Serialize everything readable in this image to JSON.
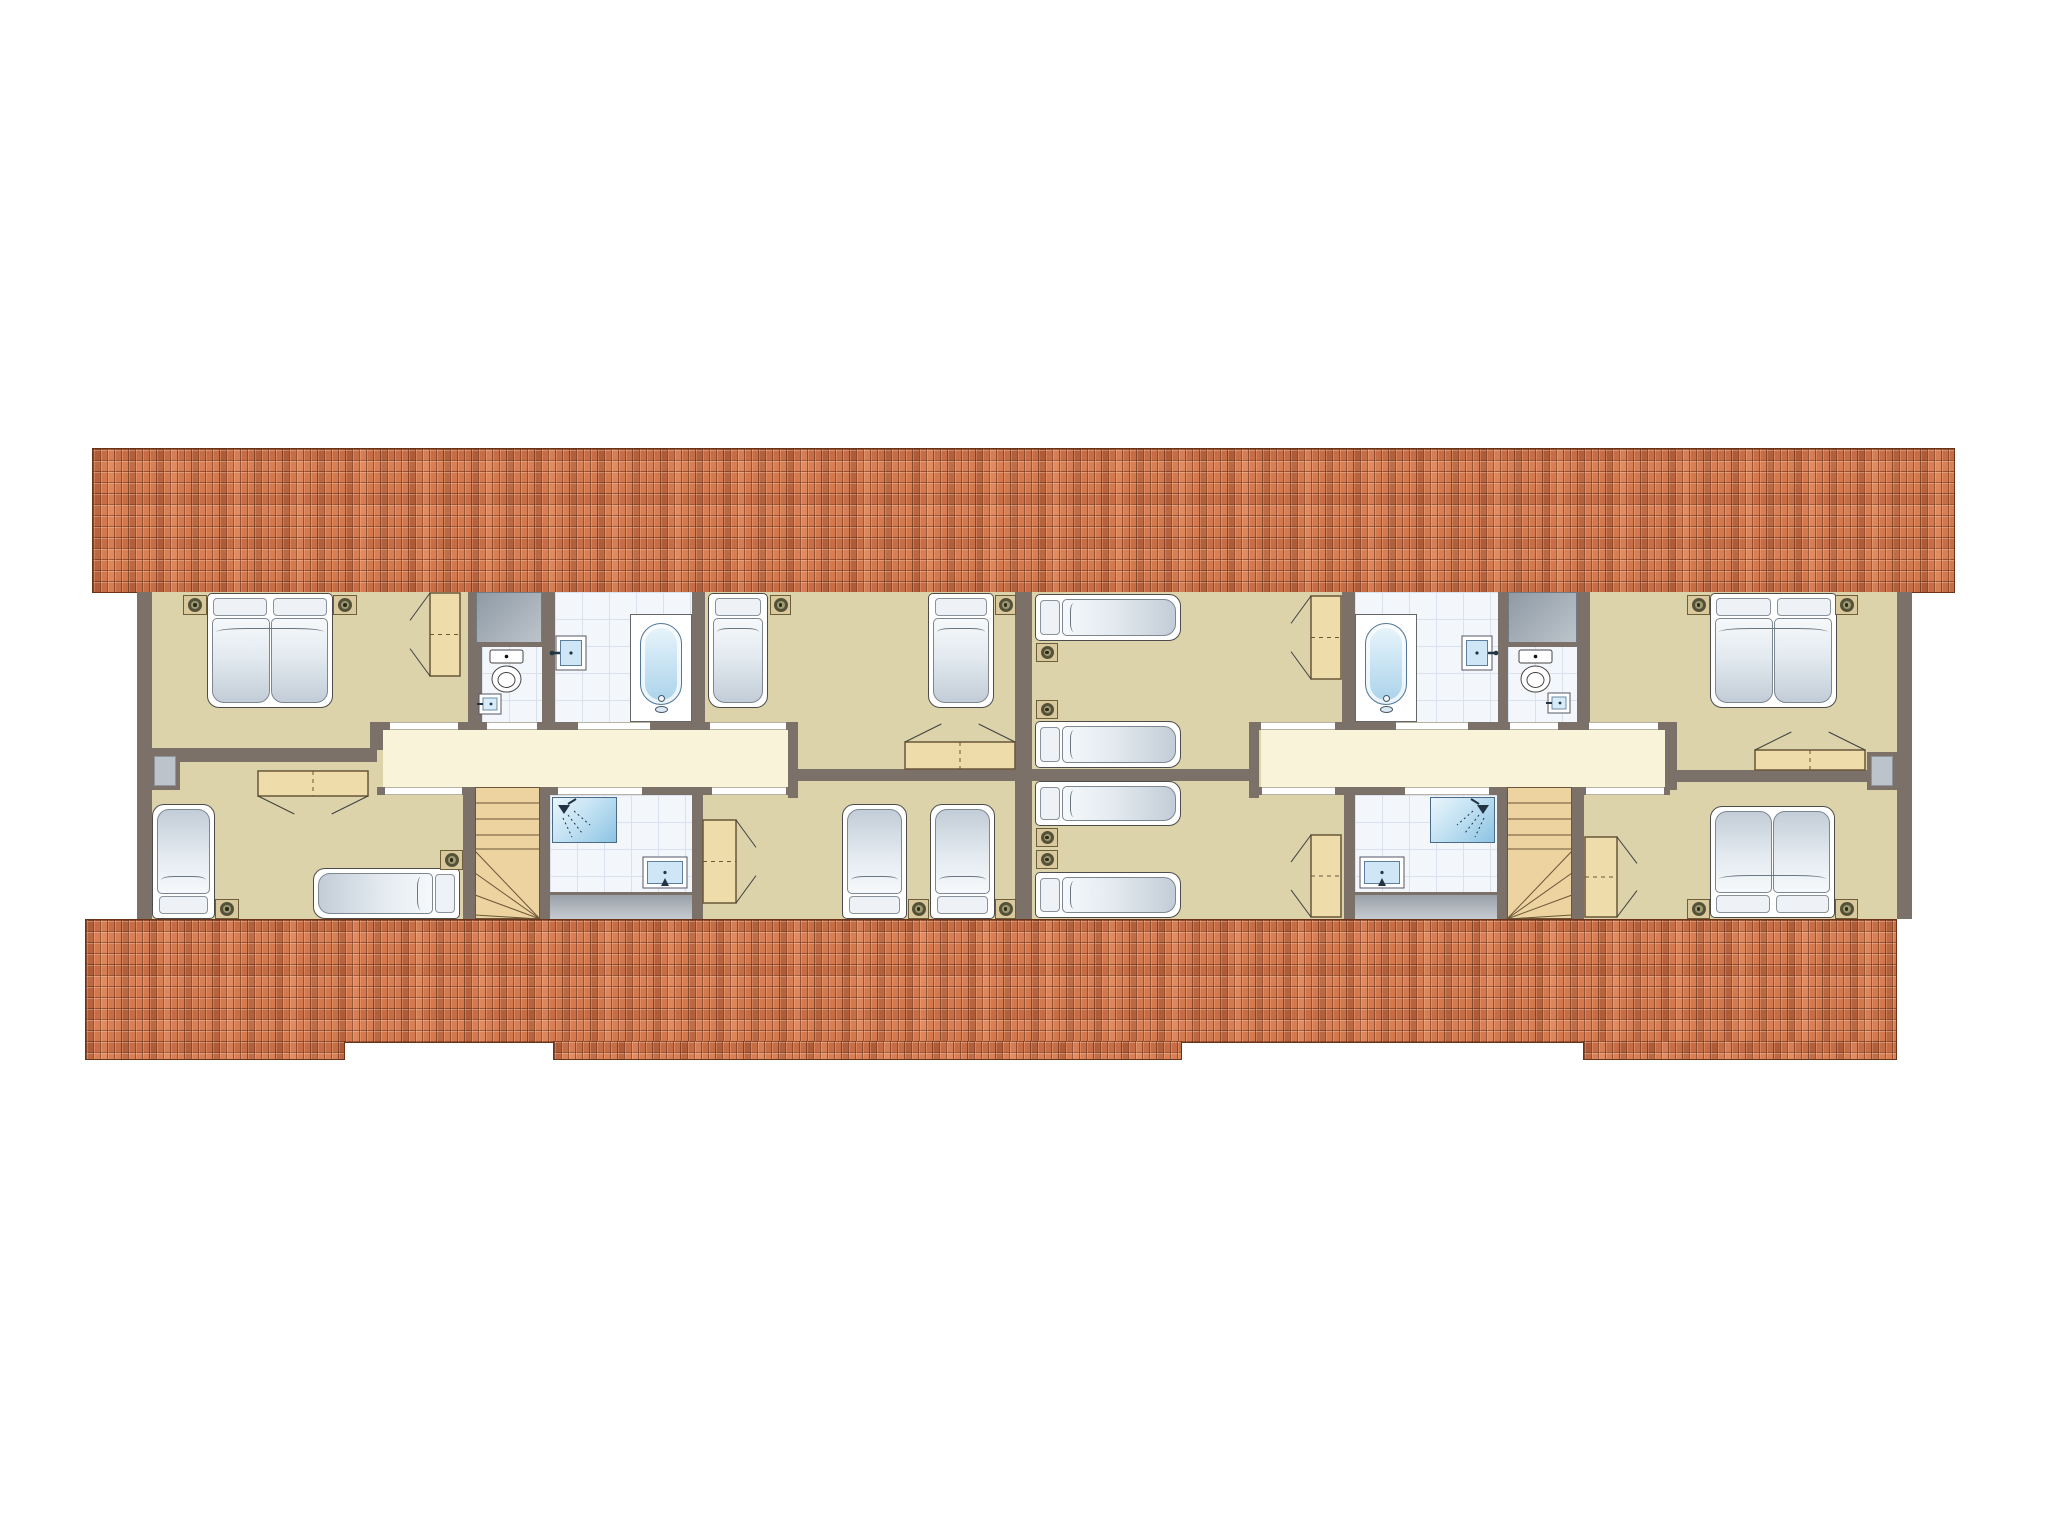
{
  "palette": {
    "background": "#ffffff",
    "wall": "#7b7168",
    "room": "#dcd3ab",
    "hall": "#f9f3da",
    "tilebg": "#f3f6fa",
    "tileline": "#d9e2ec",
    "roof": "#d4784e",
    "roofline": "#6b3418",
    "wood": "#eedcab",
    "wooddark": "#6a5638",
    "stairs": "#ecd3a0",
    "nightstand": "#d9c99c",
    "window": "#bcc3ca"
  },
  "scene": {
    "canvas": {
      "w": 2048,
      "h": 1536
    },
    "items": [
      {
        "n": "roof-band-top",
        "t": "roof",
        "x": 92,
        "y": 448,
        "w": 1863,
        "h": 145
      },
      {
        "n": "floor-base",
        "t": "beige",
        "x": 137,
        "y": 592,
        "w": 1775,
        "h": 327
      },
      {
        "n": "corridor-left",
        "t": "cream",
        "x": 383,
        "y": 730,
        "w": 405,
        "h": 57
      },
      {
        "n": "corridor-right",
        "t": "cream",
        "x": 1261,
        "y": 730,
        "w": 404,
        "h": 57
      },
      {
        "n": "wc-left-floor",
        "t": "tile",
        "x": 482,
        "y": 592,
        "w": 60,
        "h": 130
      },
      {
        "n": "bath-left-floor",
        "t": "tile",
        "x": 555,
        "y": 592,
        "w": 137,
        "h": 130
      },
      {
        "n": "shower-left-floor",
        "t": "tile",
        "x": 550,
        "y": 795,
        "w": 142,
        "h": 97
      },
      {
        "n": "bath-right-floor",
        "t": "tile",
        "x": 1355,
        "y": 592,
        "w": 143,
        "h": 130
      },
      {
        "n": "wc-right-floor",
        "t": "tile",
        "x": 1508,
        "y": 592,
        "w": 69,
        "h": 130
      },
      {
        "n": "shower-right-floor",
        "t": "tile",
        "x": 1355,
        "y": 795,
        "w": 142,
        "h": 97
      },
      {
        "n": "knee-strip-left",
        "t": "graystrip",
        "x": 550,
        "y": 892,
        "w": 142,
        "h": 27
      },
      {
        "n": "knee-strip-right",
        "t": "graystrip",
        "x": 1355,
        "y": 892,
        "w": 142,
        "h": 27
      },
      {
        "n": "wall-left-outer",
        "t": "wall",
        "x": 137,
        "y": 592,
        "w": 15,
        "h": 327
      },
      {
        "n": "wall-party",
        "t": "wall",
        "x": 1015,
        "y": 592,
        "w": 17,
        "h": 327
      },
      {
        "n": "wall-right-outer",
        "t": "wall",
        "x": 1897,
        "y": 592,
        "w": 15,
        "h": 327
      },
      {
        "n": "wall-rooma-wc",
        "t": "wall",
        "x": 468,
        "y": 592,
        "w": 14,
        "h": 138
      },
      {
        "n": "wall-wc-bath-left",
        "t": "wall",
        "x": 542,
        "y": 592,
        "w": 13,
        "h": 130
      },
      {
        "n": "wall-bath-roomb",
        "t": "wall",
        "x": 692,
        "y": 592,
        "w": 13,
        "h": 130
      },
      {
        "n": "wall-corridor-top-left",
        "t": "wall",
        "x": 377,
        "y": 722,
        "w": 421,
        "h": 8
      },
      {
        "n": "wall-corridor-left-cap",
        "t": "wall",
        "x": 370,
        "y": 722,
        "w": 13,
        "h": 28
      },
      {
        "n": "wall-ac-divider",
        "t": "wall",
        "x": 145,
        "y": 748,
        "w": 232,
        "h": 14
      },
      {
        "n": "wall-corridor-bottom-left",
        "t": "wall",
        "x": 377,
        "y": 787,
        "w": 421,
        "h": 8
      },
      {
        "n": "wall-roomc-stairs",
        "t": "wall",
        "x": 463,
        "y": 795,
        "w": 12,
        "h": 124
      },
      {
        "n": "wall-stairs-shower-left",
        "t": "wall",
        "x": 540,
        "y": 787,
        "w": 10,
        "h": 132
      },
      {
        "n": "wall-shower-roomd",
        "t": "wall",
        "x": 692,
        "y": 795,
        "w": 11,
        "h": 124
      },
      {
        "n": "wall-roomb-corridor",
        "t": "wall",
        "x": 788,
        "y": 722,
        "w": 10,
        "h": 76
      },
      {
        "n": "wall-bd-divider",
        "t": "wall",
        "x": 798,
        "y": 769,
        "w": 234,
        "h": 12
      },
      {
        "n": "wall-roome-bath",
        "t": "wall",
        "x": 1342,
        "y": 592,
        "w": 13,
        "h": 130
      },
      {
        "n": "wall-bath-wc-right",
        "t": "wall",
        "x": 1498,
        "y": 592,
        "w": 10,
        "h": 130
      },
      {
        "n": "wall-wc-roomg",
        "t": "wall",
        "x": 1577,
        "y": 592,
        "w": 13,
        "h": 138
      },
      {
        "n": "wall-corridor-top-right",
        "t": "wall",
        "x": 1259,
        "y": 722,
        "w": 411,
        "h": 8
      },
      {
        "n": "wall-corridor-right-cap",
        "t": "wall",
        "x": 1665,
        "y": 722,
        "w": 12,
        "h": 68
      },
      {
        "n": "wall-gh-divider",
        "t": "wall",
        "x": 1677,
        "y": 770,
        "w": 235,
        "h": 12
      },
      {
        "n": "wall-corridor-bottom-right",
        "t": "wall",
        "x": 1259,
        "y": 787,
        "w": 411,
        "h": 8
      },
      {
        "n": "wall-stairs-roomh",
        "t": "wall",
        "x": 1572,
        "y": 795,
        "w": 12,
        "h": 124
      },
      {
        "n": "wall-shower-stairs-right",
        "t": "wall",
        "x": 1497,
        "y": 787,
        "w": 10,
        "h": 132
      },
      {
        "n": "wall-roomf-shower",
        "t": "wall",
        "x": 1344,
        "y": 795,
        "w": 11,
        "h": 124
      },
      {
        "n": "wall-roome-corridor",
        "t": "wall",
        "x": 1249,
        "y": 722,
        "w": 10,
        "h": 76
      },
      {
        "n": "wall-ef-divider",
        "t": "wall",
        "x": 1015,
        "y": 769,
        "w": 234,
        "h": 12
      },
      {
        "n": "door-room-a",
        "t": "gap",
        "x": 390,
        "y": 722,
        "w": 68,
        "h": 8
      },
      {
        "n": "door-wc-left",
        "t": "gap",
        "x": 487,
        "y": 722,
        "w": 50,
        "h": 8
      },
      {
        "n": "door-bath-left",
        "t": "gap",
        "x": 578,
        "y": 722,
        "w": 72,
        "h": 8
      },
      {
        "n": "door-room-b",
        "t": "gap",
        "x": 710,
        "y": 722,
        "w": 76,
        "h": 8
      },
      {
        "n": "door-room-c",
        "t": "gap",
        "x": 385,
        "y": 787,
        "w": 77,
        "h": 8
      },
      {
        "n": "door-shower-left",
        "t": "gap",
        "x": 558,
        "y": 787,
        "w": 84,
        "h": 8
      },
      {
        "n": "door-room-d",
        "t": "gap",
        "x": 712,
        "y": 787,
        "w": 74,
        "h": 8
      },
      {
        "n": "door-room-e",
        "t": "gap",
        "x": 1261,
        "y": 722,
        "w": 74,
        "h": 8
      },
      {
        "n": "door-bath-right",
        "t": "gap",
        "x": 1396,
        "y": 722,
        "w": 72,
        "h": 8
      },
      {
        "n": "door-wc-right",
        "t": "gap",
        "x": 1510,
        "y": 722,
        "w": 48,
        "h": 8
      },
      {
        "n": "door-room-g",
        "t": "gap",
        "x": 1589,
        "y": 722,
        "w": 69,
        "h": 8
      },
      {
        "n": "door-room-f",
        "t": "gap",
        "x": 1262,
        "y": 787,
        "w": 73,
        "h": 8
      },
      {
        "n": "door-shower-right",
        "t": "gap",
        "x": 1405,
        "y": 787,
        "w": 84,
        "h": 8
      },
      {
        "n": "door-room-h",
        "t": "gap",
        "x": 1586,
        "y": 787,
        "w": 78,
        "h": 8
      },
      {
        "n": "duct-left",
        "t": "graybox",
        "x": 476,
        "y": 592,
        "w": 66,
        "h": 55
      },
      {
        "n": "duct-right",
        "t": "graybox",
        "x": 1508,
        "y": 592,
        "w": 69,
        "h": 55
      },
      {
        "n": "window-left",
        "t": "window",
        "x": 150,
        "y": 752,
        "w": 30,
        "h": 38
      },
      {
        "n": "window-right",
        "t": "window",
        "x": 1867,
        "y": 752,
        "w": 30,
        "h": 38
      },
      {
        "n": "stairs-left",
        "t": "stairs",
        "x": 475,
        "y": 787,
        "w": 65,
        "h": 132,
        "fan": "br"
      },
      {
        "n": "stairs-right",
        "t": "stairs",
        "x": 1507,
        "y": 787,
        "w": 65,
        "h": 132,
        "fan": "bl"
      },
      {
        "n": "nightstand-a1",
        "t": "nstand",
        "x": 183,
        "y": 595,
        "w": 24,
        "h": 20
      },
      {
        "n": "bed-room-a",
        "t": "bed",
        "x": 207,
        "y": 593,
        "w": 126,
        "h": 115,
        "o": "v",
        "p": "start",
        "d": true
      },
      {
        "n": "nightstand-a2",
        "t": "nstand",
        "x": 333,
        "y": 595,
        "w": 24,
        "h": 20
      },
      {
        "n": "wardrobe-a",
        "t": "wood",
        "x": 430,
        "y": 593,
        "w": 30,
        "h": 83,
        "s": "left"
      },
      {
        "n": "toilet-left",
        "t": "toilet",
        "x": 490,
        "y": 650,
        "w": 33,
        "h": 44
      },
      {
        "n": "corner-sink-left",
        "t": "smallsink",
        "x": 479,
        "y": 694,
        "w": 22,
        "h": 20
      },
      {
        "n": "sink-bath-left",
        "t": "sink",
        "x": 556,
        "y": 636,
        "w": 30,
        "h": 34,
        "tap": "left"
      },
      {
        "n": "bathtub-left",
        "t": "tub",
        "x": 630,
        "y": 614,
        "w": 62,
        "h": 108
      },
      {
        "n": "bed-b1",
        "t": "bed",
        "x": 708,
        "y": 593,
        "w": 60,
        "h": 115,
        "o": "v",
        "p": "start"
      },
      {
        "n": "nightstand-b1",
        "t": "nstand",
        "x": 770,
        "y": 595,
        "w": 21,
        "h": 20
      },
      {
        "n": "bed-b2",
        "t": "bed",
        "x": 928,
        "y": 593,
        "w": 66,
        "h": 115,
        "o": "v",
        "p": "start"
      },
      {
        "n": "nightstand-b2",
        "t": "nstand",
        "x": 995,
        "y": 595,
        "w": 21,
        "h": 20
      },
      {
        "n": "dresser-b",
        "t": "wood",
        "x": 905,
        "y": 742,
        "w": 110,
        "h": 27,
        "s": "top"
      },
      {
        "n": "dresser-c",
        "t": "wood",
        "x": 258,
        "y": 771,
        "w": 110,
        "h": 25,
        "s": "bottom"
      },
      {
        "n": "bed-c1",
        "t": "bed",
        "x": 152,
        "y": 804,
        "w": 63,
        "h": 115,
        "o": "v",
        "p": "end"
      },
      {
        "n": "nightstand-c1",
        "t": "nstand",
        "x": 215,
        "y": 899,
        "w": 24,
        "h": 20
      },
      {
        "n": "bed-c2",
        "t": "bed",
        "x": 313,
        "y": 868,
        "w": 147,
        "h": 51,
        "o": "h",
        "p": "end"
      },
      {
        "n": "nightstand-c2",
        "t": "nstand",
        "x": 440,
        "y": 850,
        "w": 23,
        "h": 20
      },
      {
        "n": "shower-left",
        "t": "shower",
        "x": 552,
        "y": 797,
        "w": 65,
        "h": 46,
        "corner": "tl"
      },
      {
        "n": "sink-shower-left",
        "t": "sink",
        "x": 643,
        "y": 857,
        "w": 44,
        "h": 31,
        "tap": "bottom"
      },
      {
        "n": "closet-d",
        "t": "wood",
        "x": 703,
        "y": 820,
        "w": 33,
        "h": 83,
        "s": "right"
      },
      {
        "n": "bed-d1",
        "t": "bed",
        "x": 842,
        "y": 804,
        "w": 65,
        "h": 115,
        "o": "v",
        "p": "end"
      },
      {
        "n": "nightstand-d1",
        "t": "nstand",
        "x": 908,
        "y": 899,
        "w": 21,
        "h": 20
      },
      {
        "n": "bed-d2",
        "t": "bed",
        "x": 930,
        "y": 804,
        "w": 65,
        "h": 115,
        "o": "v",
        "p": "end"
      },
      {
        "n": "nightstand-d2",
        "t": "nstand",
        "x": 995,
        "y": 899,
        "w": 21,
        "h": 20
      },
      {
        "n": "bed-e1",
        "t": "bed",
        "x": 1035,
        "y": 594,
        "w": 146,
        "h": 47,
        "o": "h",
        "p": "start"
      },
      {
        "n": "nightstand-e1",
        "t": "nstand",
        "x": 1036,
        "y": 643,
        "w": 22,
        "h": 19
      },
      {
        "n": "nightstand-e2",
        "t": "nstand",
        "x": 1036,
        "y": 700,
        "w": 22,
        "h": 19
      },
      {
        "n": "bed-e2",
        "t": "bed",
        "x": 1035,
        "y": 721,
        "w": 146,
        "h": 47,
        "o": "h",
        "p": "start"
      },
      {
        "n": "wardrobe-e",
        "t": "wood",
        "x": 1311,
        "y": 596,
        "w": 30,
        "h": 83,
        "s": "left"
      },
      {
        "n": "bathtub-right",
        "t": "tub",
        "x": 1355,
        "y": 614,
        "w": 62,
        "h": 108
      },
      {
        "n": "sink-bath-right",
        "t": "sink",
        "x": 1462,
        "y": 636,
        "w": 30,
        "h": 34,
        "tap": "right"
      },
      {
        "n": "toilet-right",
        "t": "toilet",
        "x": 1519,
        "y": 650,
        "w": 33,
        "h": 44
      },
      {
        "n": "corner-sink-right",
        "t": "smallsink",
        "x": 1548,
        "y": 693,
        "w": 22,
        "h": 20
      },
      {
        "n": "nightstand-g1",
        "t": "nstand",
        "x": 1687,
        "y": 595,
        "w": 23,
        "h": 20
      },
      {
        "n": "bed-room-g",
        "t": "bed",
        "x": 1710,
        "y": 593,
        "w": 127,
        "h": 115,
        "o": "v",
        "p": "start",
        "d": true
      },
      {
        "n": "nightstand-g2",
        "t": "nstand",
        "x": 1835,
        "y": 595,
        "w": 23,
        "h": 20
      },
      {
        "n": "dresser-g",
        "t": "wood",
        "x": 1755,
        "y": 750,
        "w": 110,
        "h": 20,
        "s": "top"
      },
      {
        "n": "bed-f1",
        "t": "bed",
        "x": 1035,
        "y": 781,
        "w": 146,
        "h": 45,
        "o": "h",
        "p": "start"
      },
      {
        "n": "nightstand-f1",
        "t": "nstand",
        "x": 1036,
        "y": 828,
        "w": 22,
        "h": 19
      },
      {
        "n": "nightstand-f2",
        "t": "nstand",
        "x": 1036,
        "y": 850,
        "w": 22,
        "h": 19
      },
      {
        "n": "bed-f2",
        "t": "bed",
        "x": 1035,
        "y": 872,
        "w": 146,
        "h": 46,
        "o": "h",
        "p": "start"
      },
      {
        "n": "wardrobe-f",
        "t": "wood",
        "x": 1311,
        "y": 835,
        "w": 30,
        "h": 82,
        "s": "left"
      },
      {
        "n": "shower-right",
        "t": "shower",
        "x": 1430,
        "y": 797,
        "w": 65,
        "h": 46,
        "corner": "tr"
      },
      {
        "n": "sink-shower-right",
        "t": "sink",
        "x": 1360,
        "y": 857,
        "w": 44,
        "h": 31,
        "tap": "bottom"
      },
      {
        "n": "closet-h",
        "t": "wood",
        "x": 1585,
        "y": 837,
        "w": 32,
        "h": 80,
        "s": "right"
      },
      {
        "n": "bed-room-h",
        "t": "bed",
        "x": 1710,
        "y": 806,
        "w": 125,
        "h": 112,
        "o": "v",
        "p": "end",
        "d": true
      },
      {
        "n": "nightstand-h1",
        "t": "nstand",
        "x": 1687,
        "y": 899,
        "w": 23,
        "h": 20
      },
      {
        "n": "nightstand-h2",
        "t": "nstand",
        "x": 1835,
        "y": 899,
        "w": 23,
        "h": 20
      },
      {
        "n": "roof-band-bottom",
        "t": "roof",
        "x": 85,
        "y": 919,
        "w": 1812,
        "h": 124
      },
      {
        "n": "roof-band-bottom-ext-left",
        "t": "roofext",
        "x": 85,
        "y": 1041,
        "w": 260,
        "h": 19
      },
      {
        "n": "roof-band-bottom-ext-mid",
        "t": "roofext",
        "x": 553,
        "y": 1041,
        "w": 629,
        "h": 19
      },
      {
        "n": "roof-band-bottom-ext-right",
        "t": "roofext",
        "x": 1583,
        "y": 1041,
        "w": 314,
        "h": 19
      }
    ]
  }
}
